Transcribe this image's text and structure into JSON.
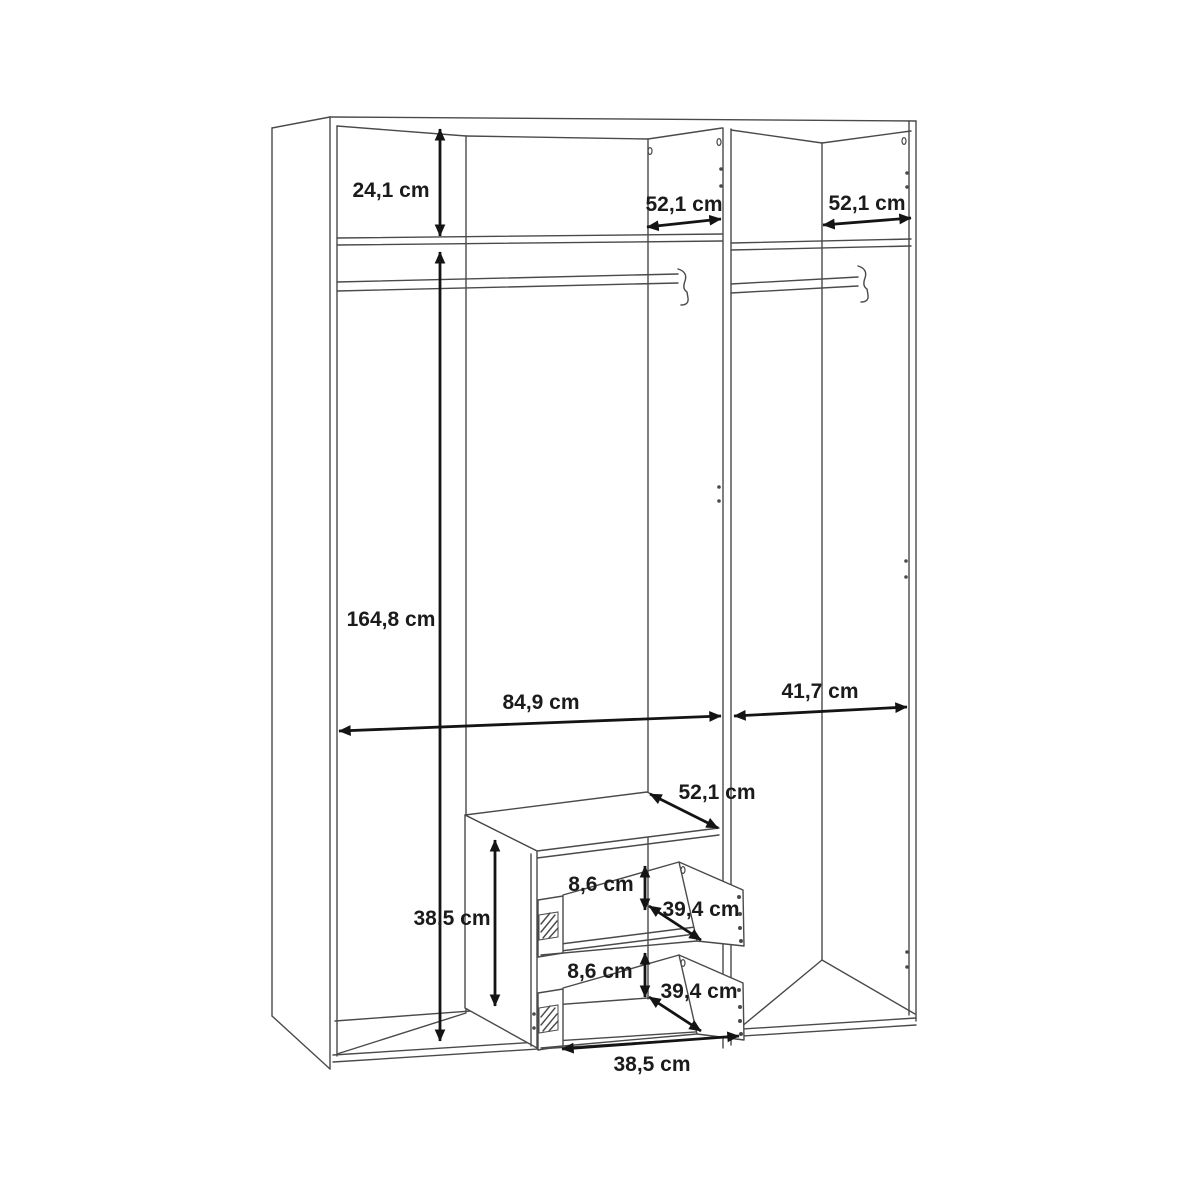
{
  "diagram": {
    "type": "furniture-interior-dimension-diagram",
    "subject": "wardrobe interior with top shelf, two hanging rails and a two-drawer insert, all dimension callouts in cm",
    "unit_suffix": "cm",
    "labels": [
      {
        "id": "top-compartment-height",
        "text": "24,1 cm"
      },
      {
        "id": "left-top-depth",
        "text": "52,1 cm"
      },
      {
        "id": "right-top-depth",
        "text": "52,1 cm"
      },
      {
        "id": "interior-height",
        "text": "164,8 cm"
      },
      {
        "id": "left-section-width",
        "text": "84,9 cm"
      },
      {
        "id": "right-section-width",
        "text": "41,7 cm"
      },
      {
        "id": "drawer-unit-top-depth",
        "text": "52,1 cm"
      },
      {
        "id": "drawer-unit-height",
        "text": "38,5 cm"
      },
      {
        "id": "upper-drawer-opening-height",
        "text": "8,6 cm"
      },
      {
        "id": "upper-drawer-depth",
        "text": "39,4 cm"
      },
      {
        "id": "lower-drawer-opening-height",
        "text": "8,6 cm"
      },
      {
        "id": "lower-drawer-depth",
        "text": "39,4 cm"
      },
      {
        "id": "drawer-unit-width",
        "text": "38,5 cm"
      }
    ]
  }
}
